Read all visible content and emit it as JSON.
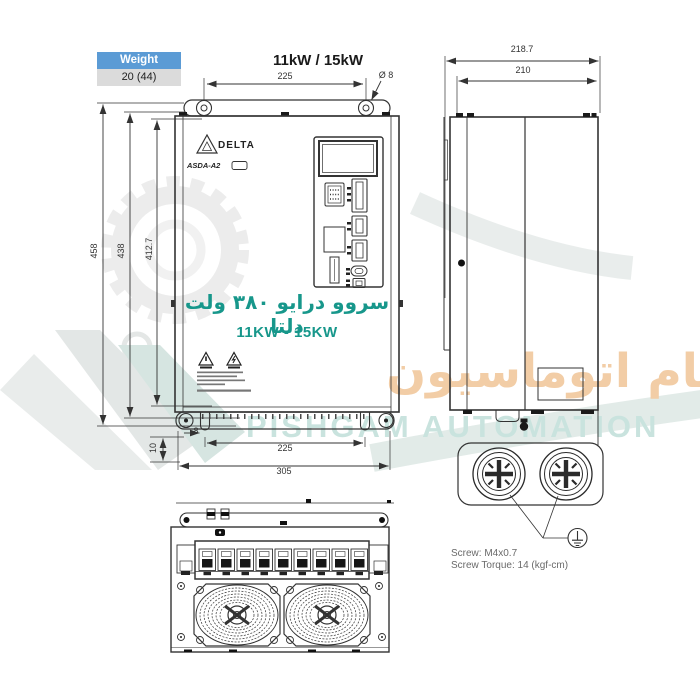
{
  "page": {
    "title": "11kW / 15kW"
  },
  "weight_table": {
    "header": "Weight",
    "value": "20 (44)"
  },
  "front_view": {
    "brand": "DELTA",
    "model": "ASDA-A2",
    "persian_caption": "سروو درایو ۳۸۰ ولت دلتا",
    "power_range": "11KW - 15KW",
    "dim_top_hole_spacing": "225",
    "dim_hole_diameter": "Ø 8",
    "dim_height_total": "458",
    "dim_height_body": "438",
    "dim_mount_hole_spacing": "412.7",
    "dim_bottom_offset": "10",
    "dim_slot_width": "8",
    "dim_bottom_hole_spacing": "225",
    "dim_width_total": "305"
  },
  "side_view": {
    "dim_depth_total": "218.7",
    "dim_depth_body": "210"
  },
  "screw_detail": {
    "screw_spec": "Screw: M4x0.7",
    "torque_spec": "Screw Torque: 14 (kgf-cm)"
  },
  "watermark": {
    "persian": "پیشگام اتوماسیون",
    "english": "PISHGAM AUTOMATION"
  },
  "icons": {
    "warning": "warning-triangle",
    "ground": "earth-ground-symbol",
    "delta_logo": "delta-triangle-logo",
    "fan": "cooling-fan",
    "screw": "phillips-screw",
    "watermark_gear": "gear"
  },
  "colors": {
    "accent_teal": "#17978B",
    "table_header_blue": "#5B9BD5",
    "table_cell_gray": "#DBDBDB",
    "watermark_orange": "#F2CDA6",
    "watermark_teal": "#C9E3DE",
    "line": "#333333"
  }
}
